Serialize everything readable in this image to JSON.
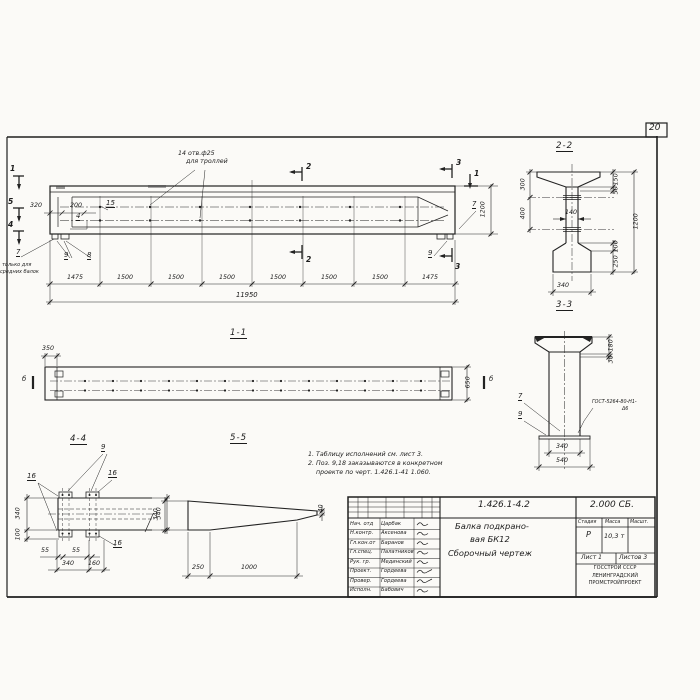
{
  "page": {
    "number": "20"
  },
  "main_view": {
    "hole_note_line1": "14 отв.ф25",
    "hole_note_line2": "для троллей",
    "mark_1": "1",
    "mark_5": "5",
    "mark_4": "4",
    "cut_2": "2",
    "cut_3": "3",
    "cut_1": "1",
    "pos_15": "15",
    "pos_4": "4",
    "pos_7": "7",
    "pos_8": "8",
    "pos_9": "9",
    "pos_7_right": "7",
    "pos_9_right": "9",
    "note_line1": "только для",
    "note_line2": "средних балок",
    "dim_320": "320",
    "dim_200": "200",
    "dim_1200": "1200",
    "chain": [
      "1475",
      "1500",
      "1500",
      "1500",
      "1500",
      "1500",
      "1500",
      "1475"
    ],
    "total": "11950"
  },
  "section_2_2": {
    "title": "2-2",
    "dim_300": "300",
    "dim_400": "400",
    "dim_150": "150",
    "dim_50": "50",
    "dim_1200": "1200",
    "dim_100": "100",
    "dim_250": "250",
    "dim_140": "140",
    "dim_340": "340"
  },
  "section_3_3": {
    "title": "3-3",
    "dim_180": "180",
    "dim_30": "30",
    "dim_340": "340",
    "dim_540": "540",
    "pos_7": "7",
    "pos_9": "9",
    "weld_note": "ГОСТ-5264-80-Н1-",
    "weld_note2": "Δ6"
  },
  "section_1_1": {
    "title": "1-1",
    "dim_350": "350",
    "dim_650": "650",
    "mark_b_left": "б",
    "mark_b_right": "б"
  },
  "section_4_4": {
    "title": "4-4",
    "pos_9": "9",
    "pos_16": "16",
    "dim_340_left": "340",
    "dim_100": "100",
    "dim_55a": "55",
    "dim_55b": "55",
    "dim_340_bottom": "340",
    "dim_160": "160",
    "dim_340_right": "340"
  },
  "section_5_5": {
    "title": "5-5",
    "dim_340": "340",
    "dim_250": "250",
    "dim_1000": "1000",
    "dim_40": "40"
  },
  "notes": {
    "line1": "1. Таблицу исполнений см. лист 3.",
    "line2": "2. Поз. 9,18 заказываются в конкретном",
    "line3": "проекте по черт. 1.426.1-41 1.060."
  },
  "title_block": {
    "doc_number": "1.426.1-4.2",
    "doc_code": "2.000 СБ.",
    "title_line1": "Балка подкрано-",
    "title_line2": "вая БК12",
    "title_line3": "Сборочный чертеж",
    "col_stage": "Стадия",
    "col_mass": "Масса",
    "col_scale": "Масшт.",
    "stage": "Р",
    "mass": "10,3 т",
    "sheet": "Лист 1",
    "sheets": "Листов 3",
    "org_line1": "ГОССТРОЙ СССР",
    "org_line2": "ЛЕНИНГРАДСКИЙ",
    "org_line3": "ПРОМСТРОЙПРОЕКТ",
    "personnel": [
      {
        "role": "Нач. отд",
        "name": "Царбак"
      },
      {
        "role": "Н.контр.",
        "name": "Аксенова"
      },
      {
        "role": "Гл.кон.от",
        "name": "Баранов"
      },
      {
        "role": "Гл.спец.",
        "name": "Палатников"
      },
      {
        "role": "Рук. гр.",
        "name": "Мединский"
      },
      {
        "role": "Проект.",
        "name": "Гордеева"
      },
      {
        "role": "Провер.",
        "name": "Гордеева"
      },
      {
        "role": "Исполн.",
        "name": "Бабович"
      }
    ]
  }
}
